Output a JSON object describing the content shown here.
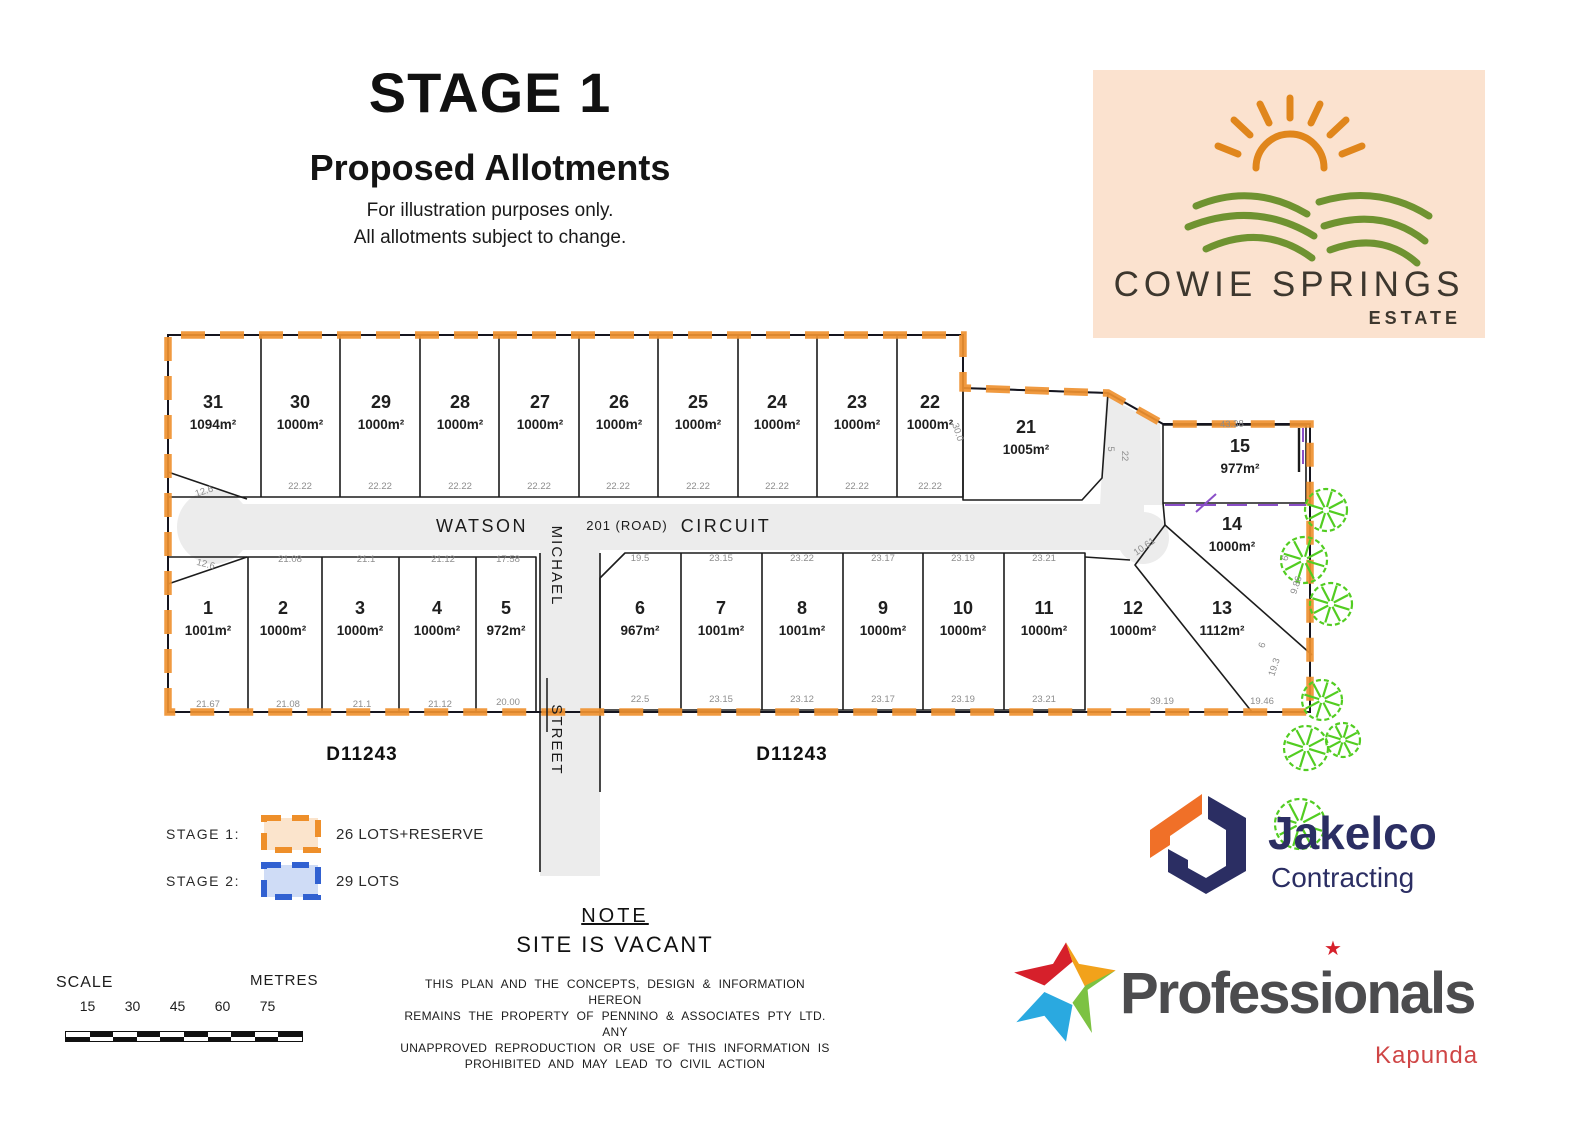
{
  "title": {
    "stage": "STAGE 1",
    "subtitle": "Proposed Allotments",
    "disclaimer1": "For illustration purposes only.",
    "disclaimer2": "All allotments subject to change."
  },
  "estate_logo": {
    "name": "COWIE SPRINGS",
    "sub": "ESTATE"
  },
  "plat": {
    "road": {
      "watson": "WATSON",
      "road_no": "201 (ROAD)",
      "circuit": "CIRCUIT",
      "michael": "MICHAEL",
      "street": "STREET"
    },
    "plan_numbers": [
      "D11243",
      "D11243"
    ],
    "lots": [
      {
        "num": "31",
        "area": "1094m²"
      },
      {
        "num": "30",
        "area": "1000m²"
      },
      {
        "num": "29",
        "area": "1000m²"
      },
      {
        "num": "28",
        "area": "1000m²"
      },
      {
        "num": "27",
        "area": "1000m²"
      },
      {
        "num": "26",
        "area": "1000m²"
      },
      {
        "num": "25",
        "area": "1000m²"
      },
      {
        "num": "24",
        "area": "1000m²"
      },
      {
        "num": "23",
        "area": "1000m²"
      },
      {
        "num": "22",
        "area": "1000m²"
      },
      {
        "num": "21",
        "area": "1005m²"
      },
      {
        "num": "15",
        "area": "977m²"
      },
      {
        "num": "14",
        "area": "1000m²"
      },
      {
        "num": "1",
        "area": "1001m²"
      },
      {
        "num": "2",
        "area": "1000m²"
      },
      {
        "num": "3",
        "area": "1000m²"
      },
      {
        "num": "4",
        "area": "1000m²"
      },
      {
        "num": "5",
        "area": "972m²"
      },
      {
        "num": "6",
        "area": "967m²"
      },
      {
        "num": "7",
        "area": "1001m²"
      },
      {
        "num": "8",
        "area": "1001m²"
      },
      {
        "num": "9",
        "area": "1000m²"
      },
      {
        "num": "10",
        "area": "1000m²"
      },
      {
        "num": "11",
        "area": "1000m²"
      },
      {
        "num": "12",
        "area": "1000m²"
      },
      {
        "num": "13",
        "area": "1112m²"
      }
    ],
    "dims": [
      "12.6",
      "22.22",
      "22.22",
      "22.22",
      "22.22",
      "22.22",
      "22.22",
      "22.22",
      "22.22",
      "22.22",
      "12.6",
      "21.08",
      "21.1",
      "21.12",
      "17.58",
      "21.67",
      "21.08",
      "21.1",
      "21.12",
      "20.00",
      "19.5",
      "23.15",
      "23.22",
      "23.17",
      "23.19",
      "23.21",
      "22.5",
      "23.15",
      "23.12",
      "23.17",
      "23.19",
      "23.21",
      "39.19",
      "19.46",
      "43.38",
      "10.61",
      "22",
      "5",
      "30.0",
      "9.86",
      "6",
      "19.3",
      "6"
    ]
  },
  "legend": {
    "stage1_label": "STAGE 1:",
    "stage1_value": "26 LOTS+RESERVE",
    "stage2_label": "STAGE 2:",
    "stage2_value": "29 LOTS"
  },
  "scalebar": {
    "label": "SCALE",
    "units": "METRES",
    "ticks": [
      "15",
      "30",
      "45",
      "60",
      "75"
    ]
  },
  "note": {
    "heading": "NOTE",
    "site_status": "SITE IS VACANT",
    "body": [
      "THIS PLAN AND THE CONCEPTS, DESIGN & INFORMATION HEREON",
      "REMAINS THE PROPERTY OF PENNINO & ASSOCIATES PTY LTD. ANY",
      "UNAPPROVED REPRODUCTION OR USE OF THIS INFORMATION IS",
      "PROHIBITED AND MAY LEAD TO CIVIL ACTION"
    ]
  },
  "jakelco": {
    "name": "Jakelco",
    "sub": "Contracting"
  },
  "professionals": {
    "name": "Professionals",
    "location": "Kapunda",
    "i_star": "★"
  },
  "colors": {
    "stage1_orange": "#ef9130",
    "stage1_fill": "#fbe4cc",
    "stage2_blue": "#3161d1",
    "stage2_fill": "#cfdcf6",
    "road_gray": "#ececec",
    "tree_green": "#52cd21",
    "jakelco_navy": "#2b2e63",
    "jakelco_orange": "#f07028",
    "professionals_red": "#d6202b",
    "professionals_gray": "#4c4c4e",
    "estate_logo_bg": "#fbe2cf",
    "estate_text": "#3d372e",
    "utility_purple": "#8a4fc8"
  }
}
